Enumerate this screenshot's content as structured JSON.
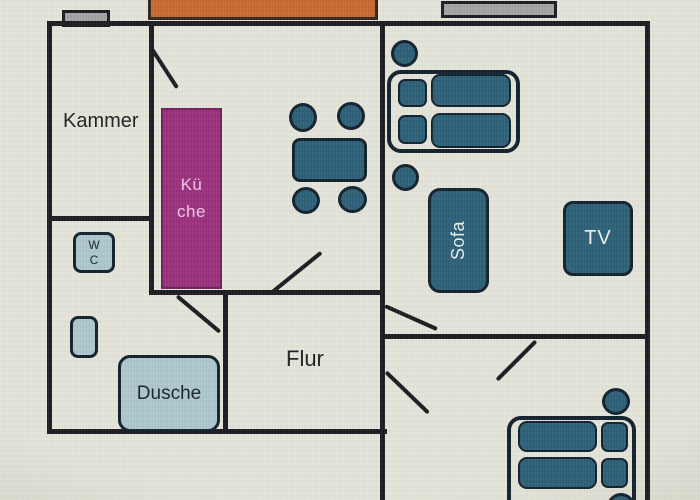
{
  "floorplan": {
    "labels": {
      "kammer": "Kammer",
      "kueche_line1": "Kü",
      "kueche_line2": "che",
      "wc_line1": "W",
      "wc_line2": "C",
      "dusche": "Dusche",
      "flur": "Flur",
      "sofa": "Sofa",
      "tv": "TV"
    },
    "colors": {
      "background": "#e5e5da",
      "wall": "#1a1a20",
      "furniture_teal": "#2b5f77",
      "furniture_edge": "#10202c",
      "kitchen_purple": "#9b2f7d",
      "balcony_orange": "#c8692e",
      "bath_blue": "#adc8cd",
      "window_gray": "#a2a3a3"
    }
  }
}
